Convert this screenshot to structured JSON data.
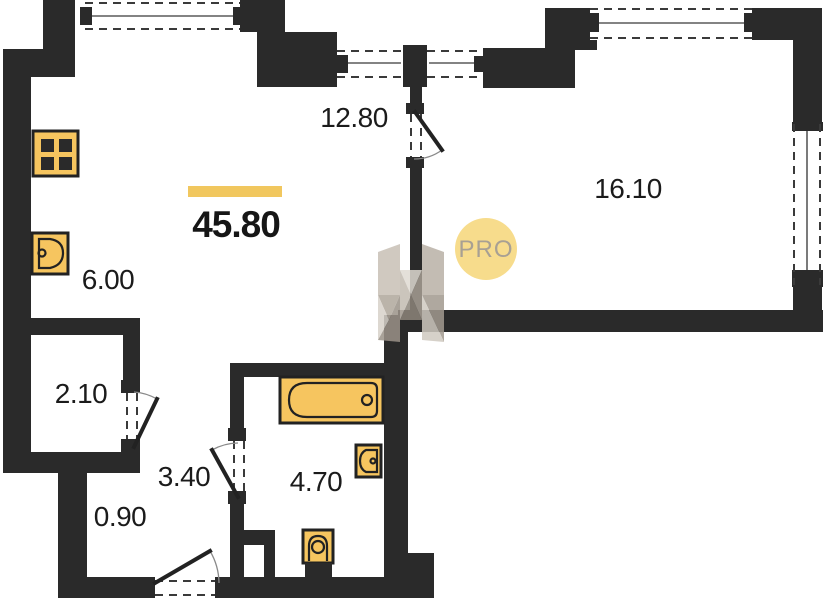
{
  "plan": {
    "total_area": "45.80",
    "zones": {
      "living": "12.80",
      "bedroom": "16.10",
      "kitchen": "6.00",
      "wardrobe": "2.10",
      "hallway": "3.40",
      "bathroom": "4.70",
      "entry": "0.90"
    },
    "watermark_badge": "PRO",
    "colors": {
      "wall": "#2a2a2a",
      "fixture_fill": "#f6c55f",
      "accent_bar": "#f1c75e",
      "badge_fill": "#f7dc8c",
      "badge_text": "#a8a093"
    }
  }
}
